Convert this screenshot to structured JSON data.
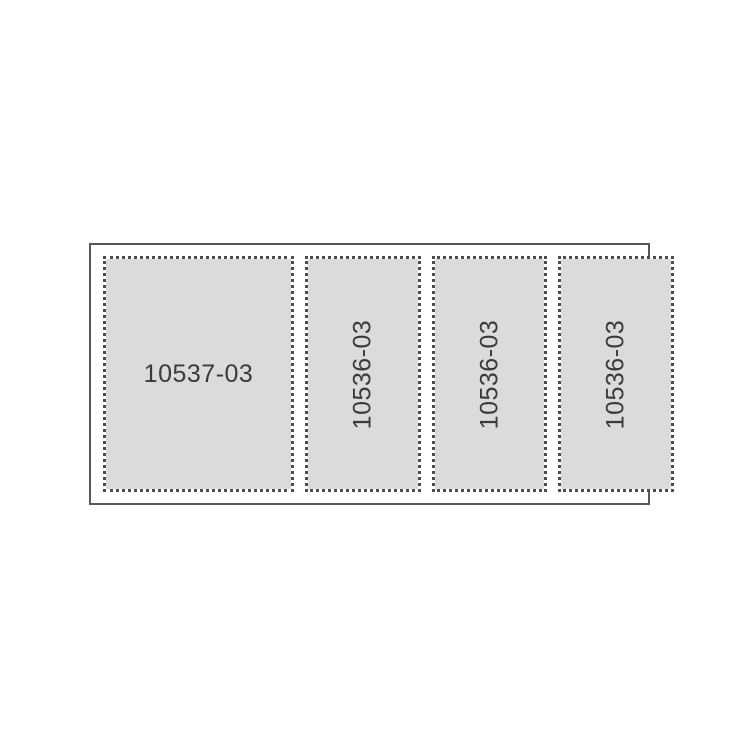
{
  "figure": {
    "frame": {
      "description": "outer solid-border sheet outline"
    },
    "panels": [
      {
        "label": "10537-03",
        "orientation": "horizontal"
      },
      {
        "label": "10536-03",
        "orientation": "vertical"
      },
      {
        "label": "10536-03",
        "orientation": "vertical"
      },
      {
        "label": "10536-03",
        "orientation": "vertical"
      }
    ]
  },
  "colors": {
    "background": "#ffffff",
    "frame_border": "#58585a",
    "panel_fill": "#dbdbdb",
    "panel_dotted_border": "#4d4d4d",
    "label_text": "#3a3a3a"
  }
}
